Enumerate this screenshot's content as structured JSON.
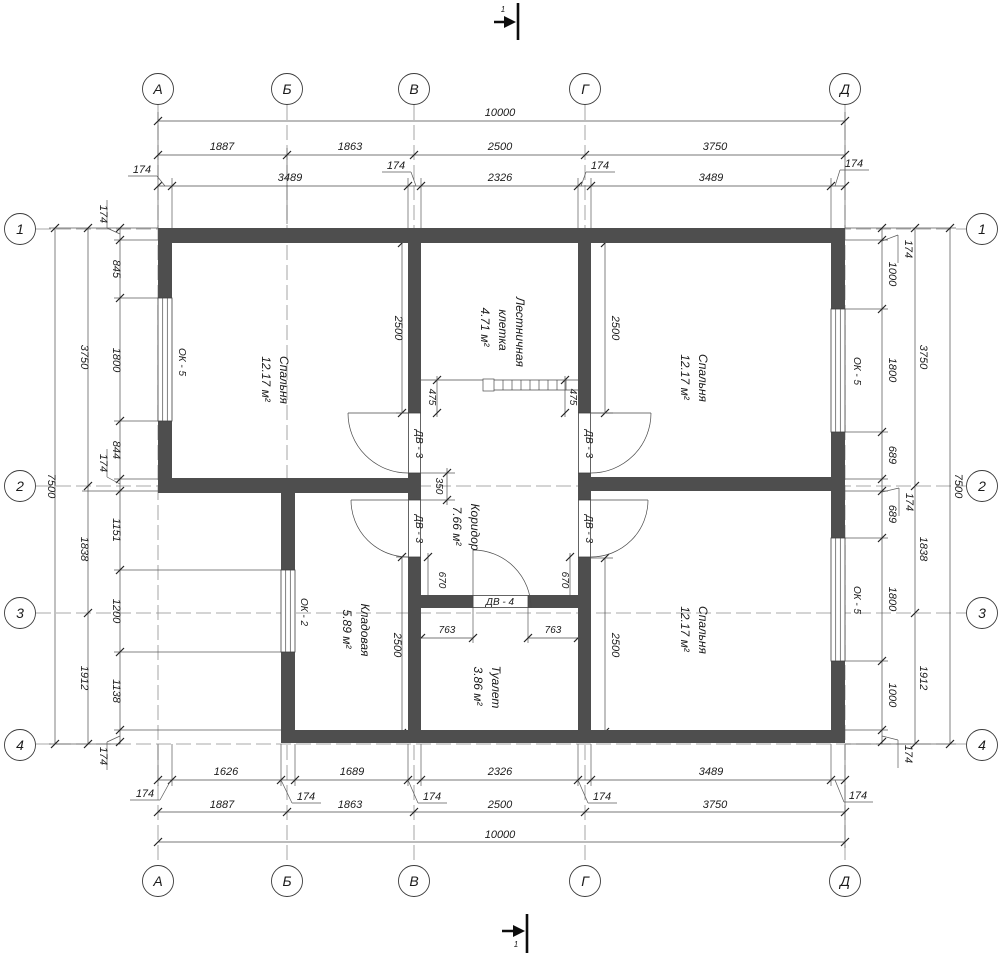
{
  "grid_axes": {
    "top": [
      "А",
      "Б",
      "В",
      "Г",
      "Д"
    ],
    "bottom": [
      "А",
      "Б",
      "В",
      "Г",
      "Д"
    ],
    "left": [
      "1",
      "2",
      "3",
      "4"
    ],
    "right": [
      "1",
      "2",
      "3",
      "4"
    ]
  },
  "section_marks": {
    "top": "1",
    "bottom": "1"
  },
  "dims_top": {
    "overall": "10000",
    "axis": [
      "1887",
      "1863",
      "2500",
      "3750"
    ],
    "inner": [
      "3489",
      "2326",
      "3489"
    ],
    "offsets": [
      "174",
      "174",
      "174",
      "174"
    ]
  },
  "dims_bottom": {
    "overall": "10000",
    "axis": [
      "1887",
      "1863",
      "2500",
      "3750"
    ],
    "inner": [
      "1626",
      "1689",
      "2326",
      "3489"
    ],
    "offsets": [
      "174",
      "174",
      "174",
      "174",
      "174"
    ]
  },
  "dims_left": {
    "overall": "7500",
    "axis": [
      "3750",
      "1838",
      "1912"
    ],
    "inner": [
      "845",
      "1800",
      "844",
      "1151",
      "1200",
      "1138"
    ],
    "offsets": [
      "174",
      "174",
      "174"
    ]
  },
  "dims_right": {
    "overall": "7500",
    "axis": [
      "3750",
      "1838",
      "1912"
    ],
    "inner": [
      "1000",
      "1800",
      "689",
      "689",
      "1800",
      "1000"
    ],
    "offsets": [
      "174",
      "174",
      "174"
    ]
  },
  "dims_interior": {
    "bedroom_left_2500": "2500",
    "bedroom_top_right_2500": "2500",
    "storage_2500": "2500",
    "bedroom_bottom_right_2500": "2500",
    "stair_475_left": "475",
    "stair_475_right": "475",
    "corridor_350": "350",
    "corridor_670_left": "670",
    "corridor_670_right": "670",
    "toilet_763_left": "763",
    "toilet_763_right": "763"
  },
  "rooms": {
    "bedroom_left": {
      "name": "Спальня",
      "area": "12.17 м²"
    },
    "bedroom_top_right": {
      "name": "Спальня",
      "area": "12.17 м²"
    },
    "bedroom_bottom_right": {
      "name": "Спальня",
      "area": "12.17 м²"
    },
    "stairwell": {
      "name_line1": "Лестничная",
      "name_line2": "клетка",
      "area": "4.71 м²"
    },
    "corridor": {
      "name": "Коридор",
      "area": "7.66 м²"
    },
    "storage": {
      "name": "Кладовая",
      "area": "5.89 м²"
    },
    "toilet": {
      "name": "Туалет",
      "area": "3.86 м²"
    }
  },
  "openings": {
    "window_left": "ОК - 5",
    "window_right_top": "ОК - 5",
    "window_right_bottom": "ОК - 5",
    "window_storage": "ОК - 2",
    "door_left_top": "ДВ - 3",
    "door_left_bottom": "ДВ - 3",
    "door_right_top": "ДВ - 3",
    "door_right_bottom": "ДВ - 3",
    "door_toilet": "ДВ - 4"
  },
  "colors": {
    "wall": "#4e4e4e",
    "line": "#3e3e3e",
    "background": "#ffffff"
  }
}
